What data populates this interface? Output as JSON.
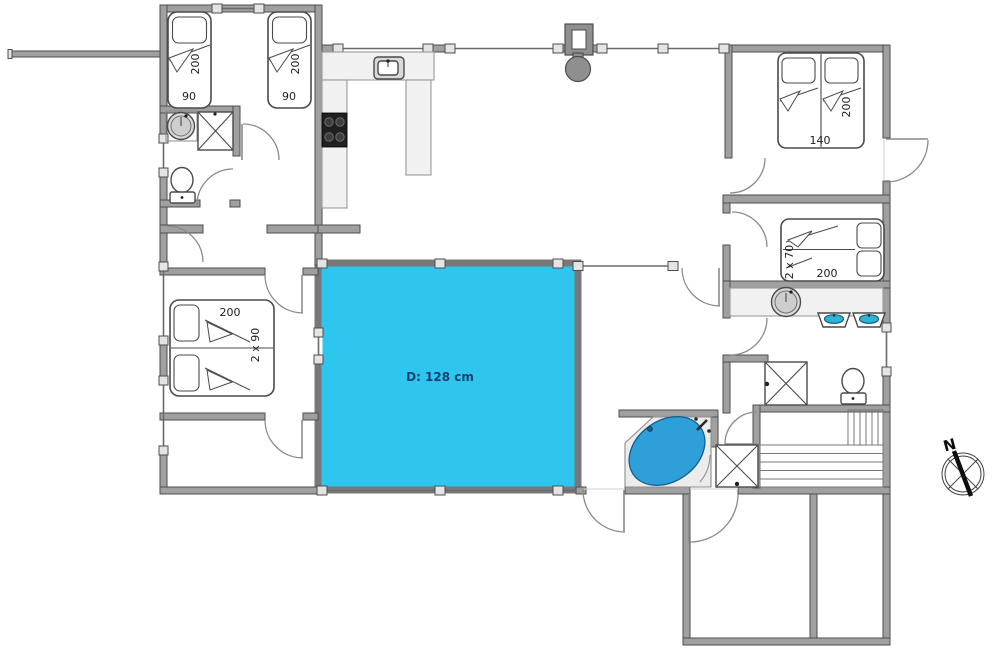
{
  "pool": {
    "label": "D: 128 cm"
  },
  "compass": {
    "north": "N"
  },
  "beds": {
    "nw_left": {
      "length": "200",
      "width": "90"
    },
    "nw_right": {
      "length": "200",
      "width": "90"
    },
    "ne_double": {
      "length": "200",
      "width": "140"
    },
    "east_bunk": {
      "length": "200",
      "width": "2 x 70"
    },
    "sw_double": {
      "length": "200",
      "width": "2 x 90"
    }
  },
  "colors": {
    "pool_water": "#2EC6EF",
    "spa_water": "#2E9FD9",
    "basin_water": "#2FB4D6",
    "pool_label": "#17406E"
  }
}
